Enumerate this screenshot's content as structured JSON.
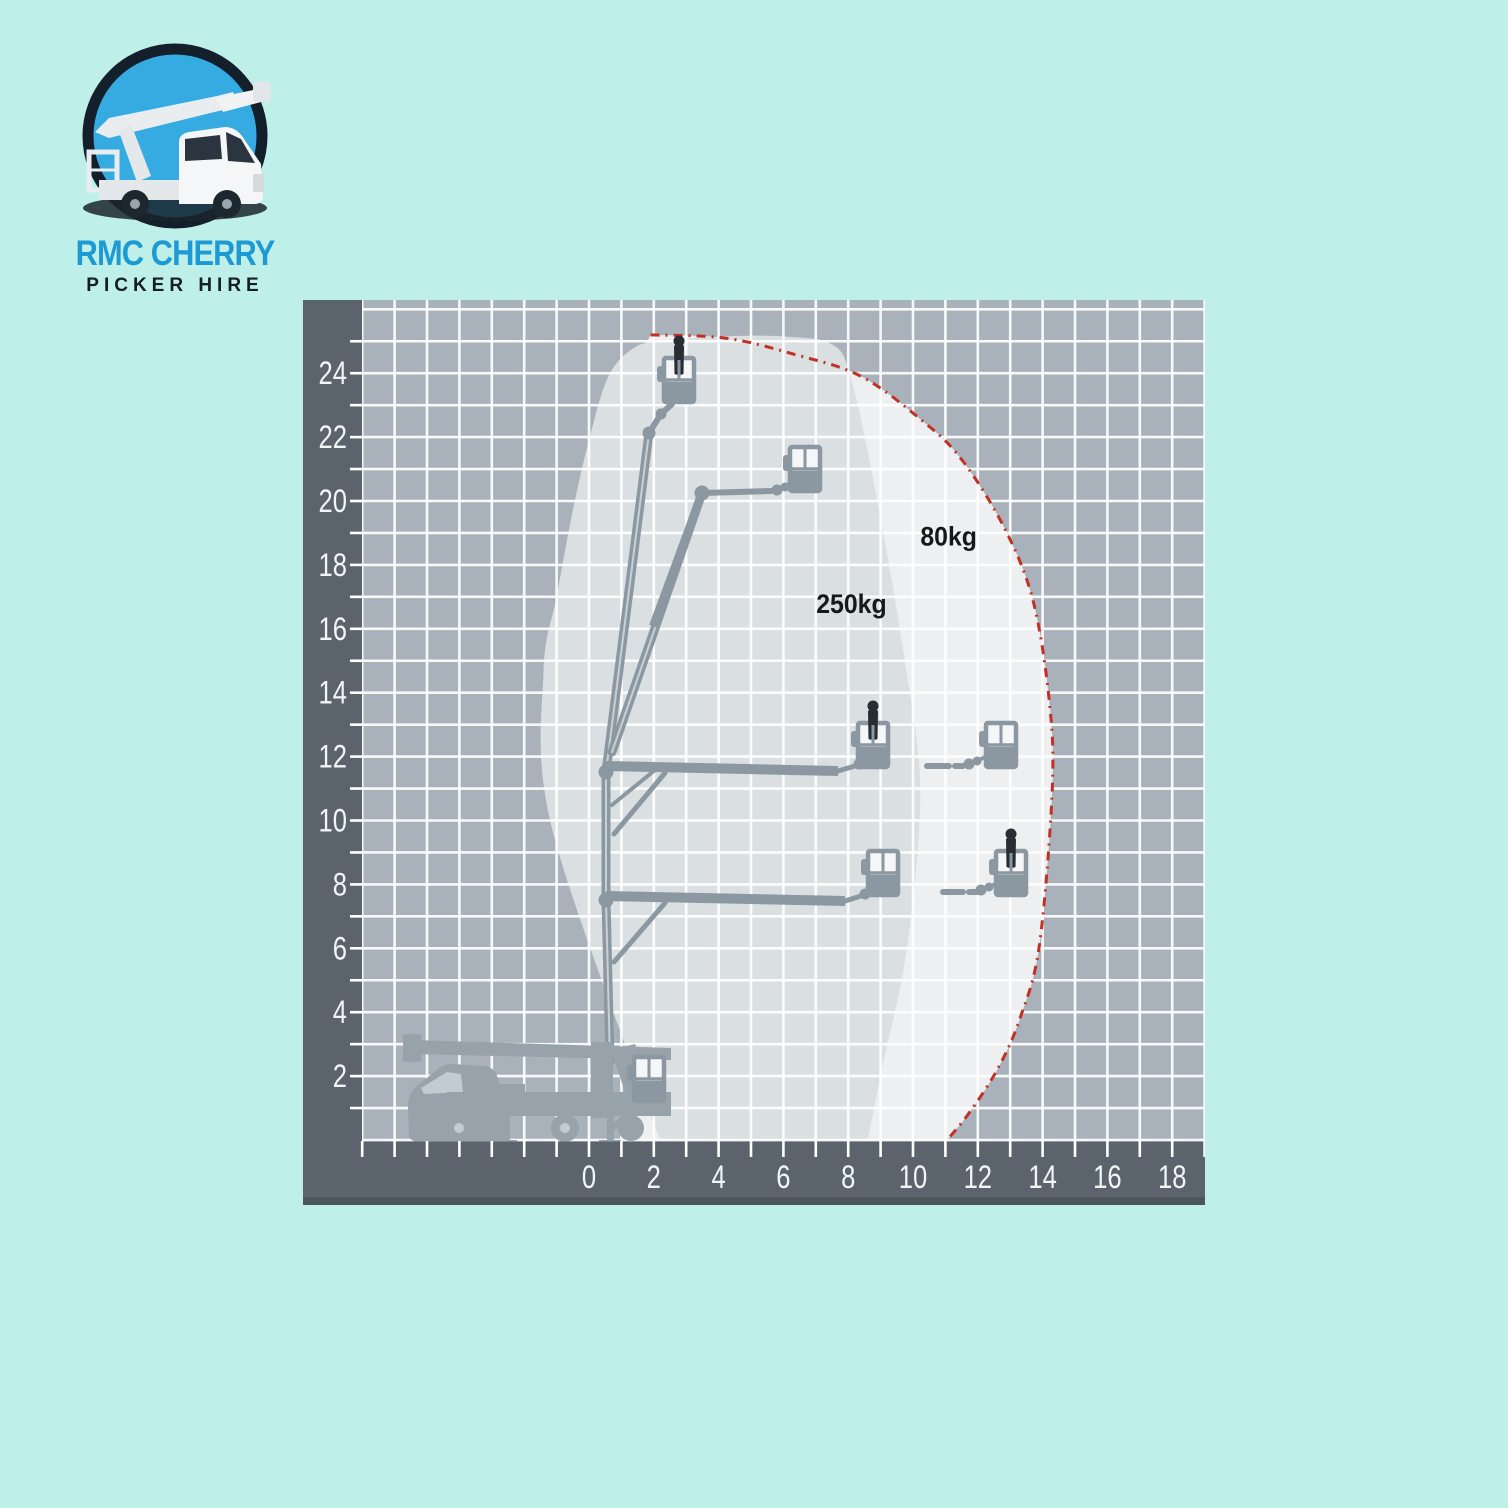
{
  "logo": {
    "title": "RMC CHERRY",
    "subtitle": "PICKER HIRE",
    "mark": "cherry-picker-truck-in-circle"
  },
  "colors": {
    "page_bg": "#bfefe9",
    "panel_bg": "#a9b2ba",
    "band": "#5b646d",
    "band_edge": "#4d555d",
    "grid_line": "#ffffff",
    "zone_250": "#dadfe2",
    "zone_80": "#edeff1",
    "limit_line": "#c23126",
    "machine": "#8c98a1",
    "machine_highlight": "#c9d0d5",
    "truck": "#97a2aa",
    "truck_window": "#c2cbd1",
    "basket_fill": "#f4f6f7",
    "person": "#272d33",
    "tick_text": "#f2f5f6",
    "zone_text": "#15191c",
    "logo_blue": "#1d9ad3",
    "logo_dark": "#141e28",
    "logo_circle": "#36abe2",
    "logo_ring": "#131f2a",
    "logo_truck_white": "#f4f6f7",
    "logo_shadow": "#1a242c"
  },
  "chart_data": {
    "type": "area",
    "description_visible_text_only": true,
    "x_axis": {
      "tick_labels": [
        0,
        2,
        4,
        6,
        8,
        10,
        12,
        14,
        16,
        18
      ],
      "minor_step": 1,
      "range": [
        -7,
        19
      ]
    },
    "y_axis": {
      "tick_labels": [
        2,
        4,
        6,
        8,
        10,
        12,
        14,
        16,
        18,
        20,
        22,
        24
      ],
      "minor_step": 1,
      "range": [
        0,
        26.4
      ]
    },
    "grid": true,
    "max_outreach_m": 14.3,
    "max_height_m": 25.2,
    "zones": [
      {
        "label": "250kg",
        "label_pos_m": [
          8.1,
          16.5
        ],
        "boundary_m": [
          [
            2.2,
            0
          ],
          [
            1.5,
            1.9
          ],
          [
            -1.2,
            10.0
          ],
          [
            -1.4,
            14.7
          ],
          [
            -1.0,
            17.0
          ],
          [
            -0.5,
            19.7
          ],
          [
            0.0,
            21.9
          ],
          [
            0.6,
            23.9
          ],
          [
            1.4,
            24.8
          ],
          [
            2.3,
            25.0
          ],
          [
            4.1,
            25.15
          ],
          [
            6.0,
            25.15
          ],
          [
            7.5,
            24.9
          ],
          [
            8.1,
            23.8
          ],
          [
            8.9,
            20.0
          ],
          [
            9.7,
            15.3
          ],
          [
            10.2,
            11.6
          ],
          [
            10.1,
            8.5
          ],
          [
            9.7,
            5.3
          ],
          [
            9.1,
            2.5
          ],
          [
            8.6,
            0
          ]
        ]
      },
      {
        "label": "80kg",
        "label_pos_m": [
          11.1,
          18.6
        ],
        "outer_boundary_m": [
          [
            1.9,
            25.2
          ],
          [
            4.2,
            25.1
          ],
          [
            6.3,
            24.6
          ],
          [
            8.4,
            23.9
          ],
          [
            10.3,
            22.5
          ],
          [
            11.5,
            21.3
          ],
          [
            12.8,
            19.2
          ],
          [
            13.7,
            16.9
          ],
          [
            14.2,
            13.8
          ],
          [
            14.3,
            11.0
          ],
          [
            13.9,
            6.1
          ],
          [
            13.3,
            3.8
          ],
          [
            12.6,
            2.2
          ],
          [
            11.7,
            0.8
          ],
          [
            11.05,
            0
          ]
        ],
        "closure_m": [
          [
            1.2,
            0
          ],
          [
            0.9,
            12.0
          ],
          [
            1.3,
            24.0
          ]
        ]
      }
    ]
  }
}
